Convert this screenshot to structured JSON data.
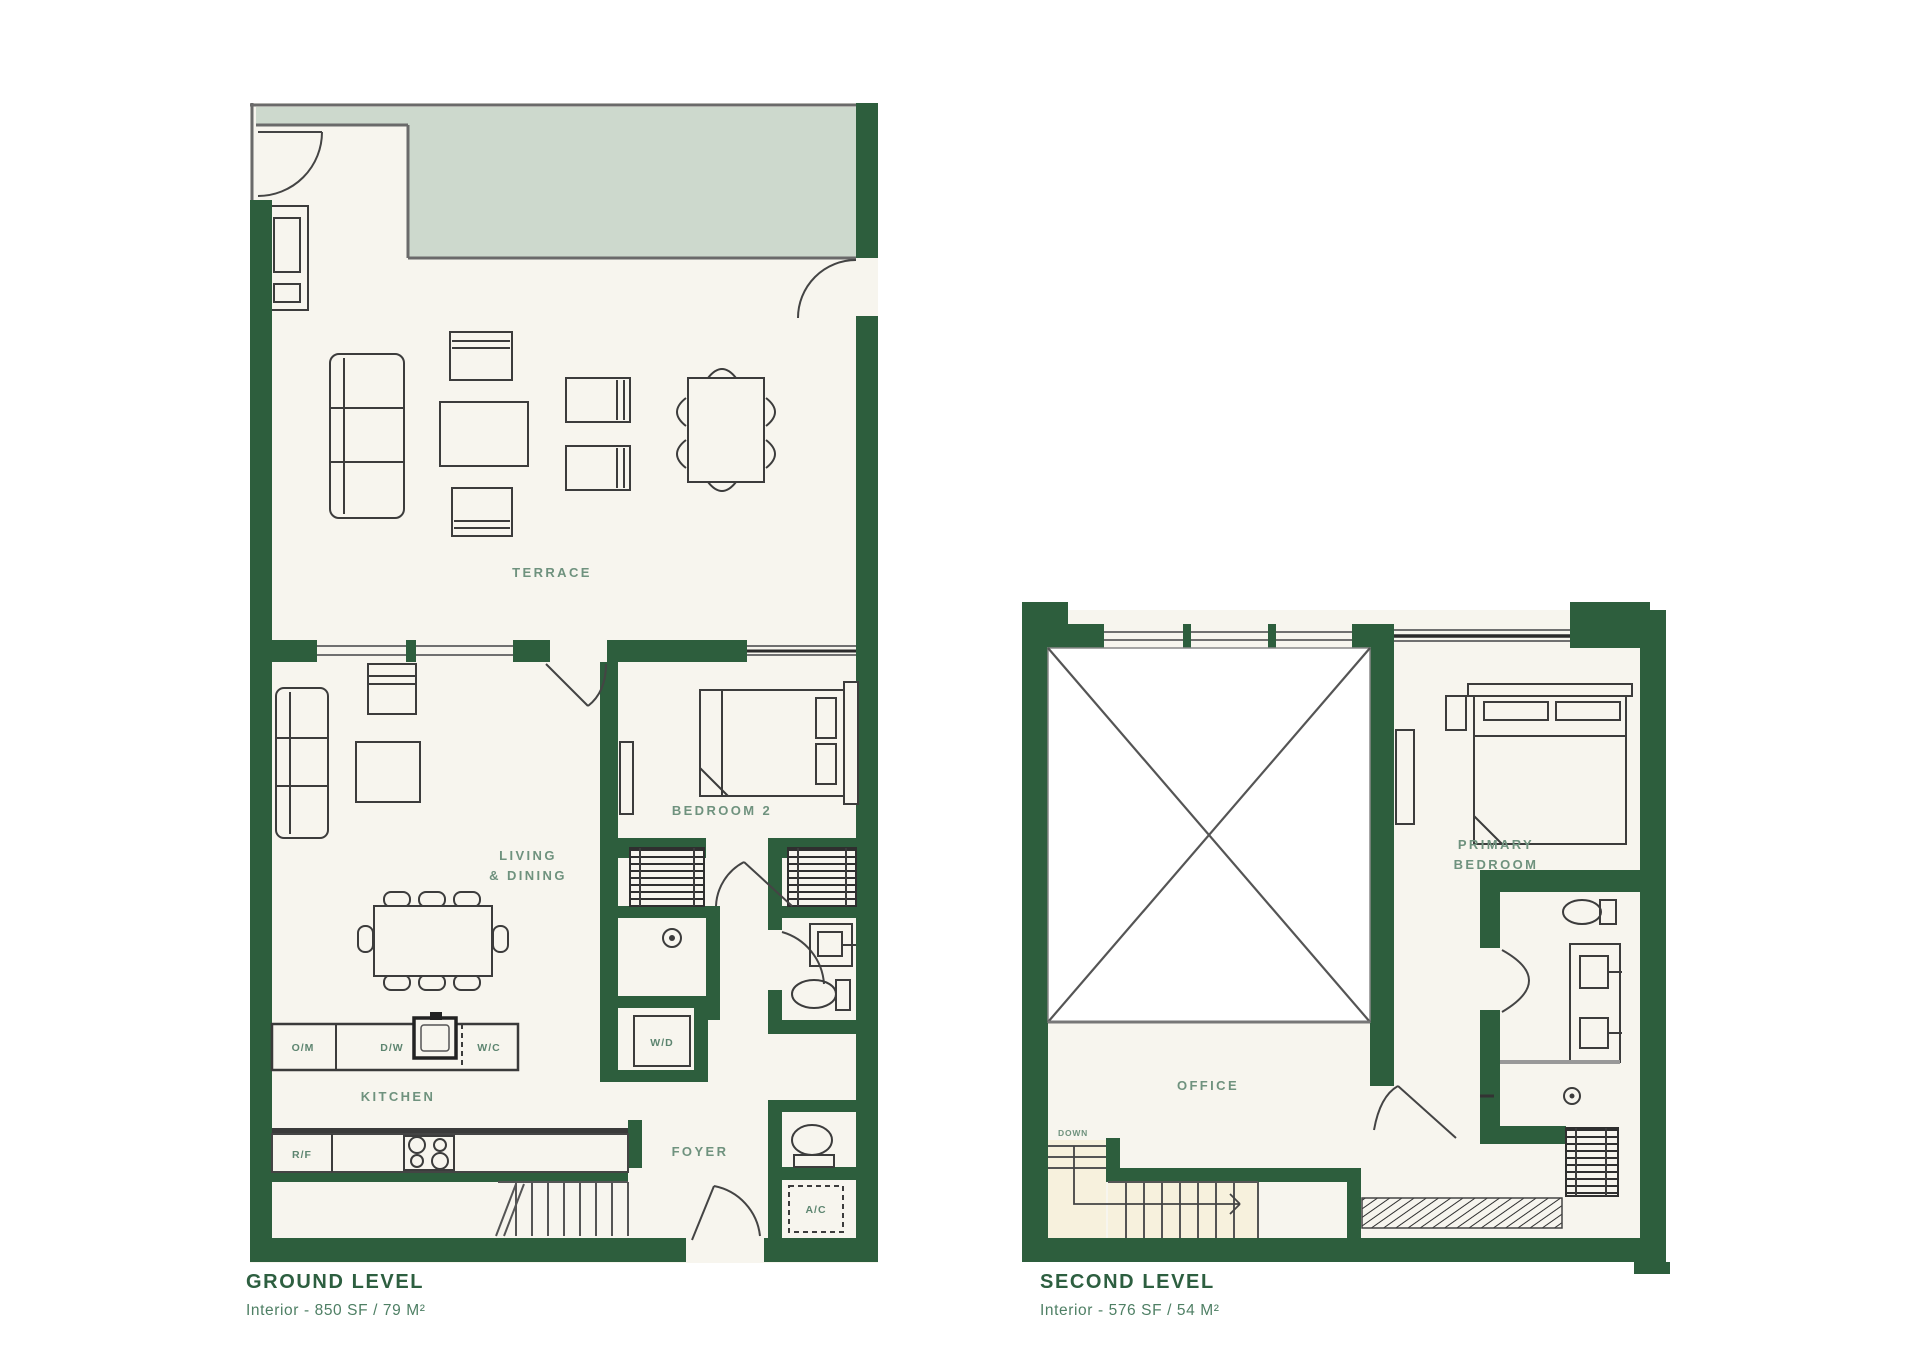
{
  "palette": {
    "wall_green": "#2d5e3d",
    "sage_fill": "#cdd9cd",
    "floor_fill": "#f7f5ee",
    "stair_floor_fill": "#f7f1dd",
    "void_fill": "#ffffff",
    "furniture_line": "#3c3c3c",
    "room_label_green": "#6f927e",
    "caption_green": "#2d5f40",
    "subcaption_green": "#4e7f64"
  },
  "ground_level": {
    "caption": "GROUND LEVEL",
    "area_text": "Interior - 850 SF / 79 M²",
    "rooms": {
      "terrace": "TERRACE",
      "living_line1": "LIVING",
      "living_line2": "& DINING",
      "bedroom2": "BEDROOM 2",
      "kitchen": "KITCHEN",
      "foyer": "FOYER"
    },
    "fixtures": {
      "washer_dryer": "W/D",
      "air_conditioner": "A/C",
      "fridge": "R/F",
      "oven_microwave": "O/M",
      "dishwasher": "D/W",
      "wine_cooler": "W/C"
    }
  },
  "second_level": {
    "caption": "SECOND LEVEL",
    "area_text": "Interior - 576 SF / 54 M²",
    "rooms": {
      "office": "OFFICE",
      "primary_line1": "PRIMARY",
      "primary_line2": "BEDROOM"
    },
    "fixtures": {
      "down": "DOWN"
    }
  }
}
